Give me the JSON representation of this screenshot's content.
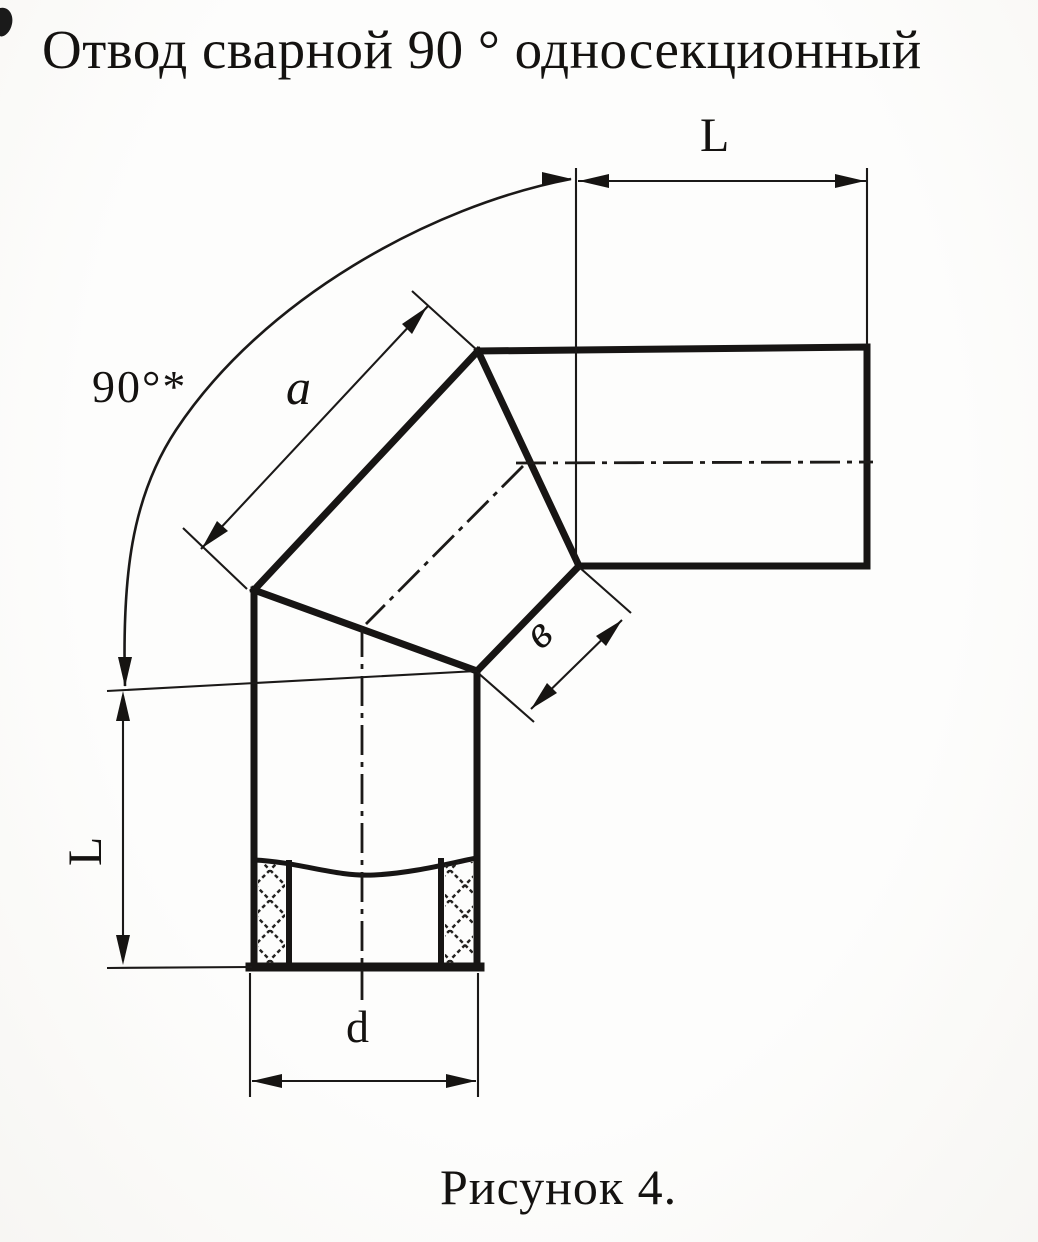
{
  "header": {
    "title": "Отвод сварной 90 ° односекционный"
  },
  "caption": {
    "text": "Рисунок 4."
  },
  "dimensions": {
    "top_length": "L",
    "left_length": "L",
    "angle": "90°*",
    "face_a": "a",
    "face_b": "в",
    "diameter": "d"
  },
  "colors": {
    "ink": "#161412",
    "paper": "#fbfaf7"
  }
}
